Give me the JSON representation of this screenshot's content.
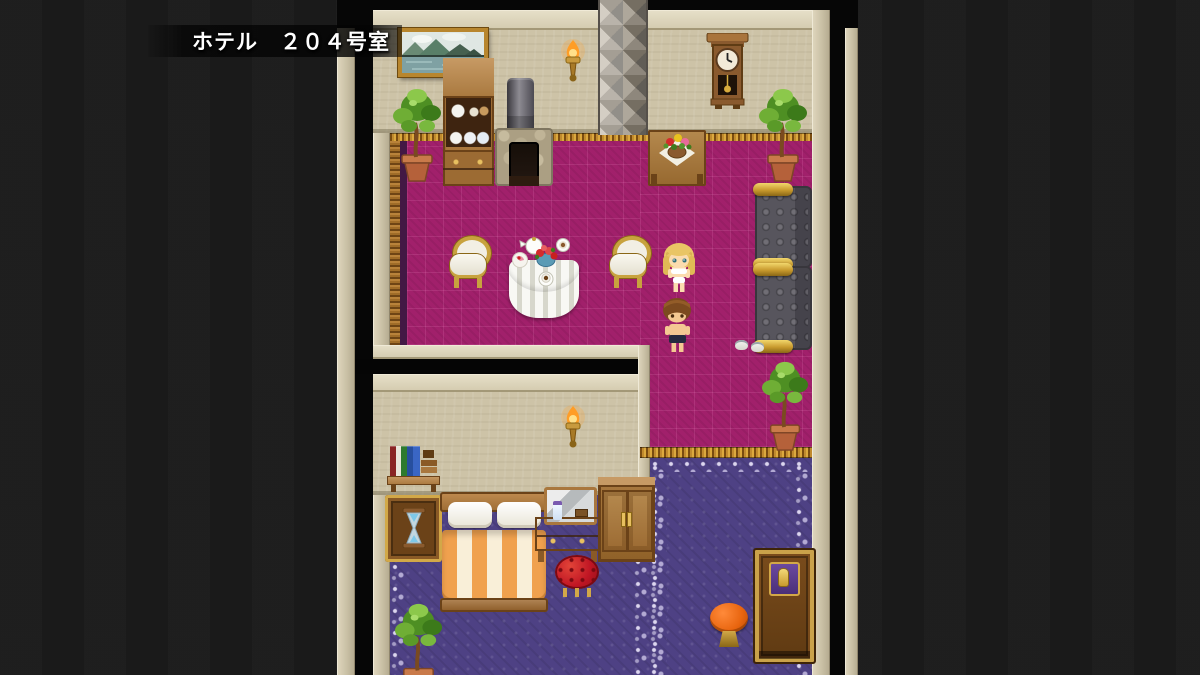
{
  "banner": {
    "location_label": "ホテル　２０４号室"
  },
  "scene": {
    "map_name": "hotel-room-204",
    "rooms": [
      "dining-room",
      "bedroom",
      "hallway"
    ],
    "characters": [
      {
        "id": "girl",
        "hair_color": "blonde",
        "outfit": "white-underwear"
      },
      {
        "id": "boy",
        "hair_color": "brown",
        "outfit": "dark-shorts"
      }
    ],
    "objects": [
      "landscape-painting",
      "wall-lamp",
      "tiled-pillar",
      "wall-clock",
      "potted-plant",
      "china-cabinet",
      "stone-stove",
      "flower-table",
      "round-dining-table",
      "dining-chair",
      "sofa",
      "slippers",
      "bookshelf",
      "hourglass-table",
      "bed",
      "vanity-dresser",
      "wardrobe",
      "red-stool",
      "room-door",
      "orange-side-table"
    ],
    "colors": {
      "background": "#1b1b1b",
      "wall": "#cdc3a7",
      "dining_carpet": "#a1206b",
      "hall_carpet": "#4e4184",
      "trim_gold": "#c08a2e",
      "sofa_gray": "#57555d",
      "bed_stripe": "#f0a14e",
      "door_wood": "#7a4c1c"
    }
  }
}
